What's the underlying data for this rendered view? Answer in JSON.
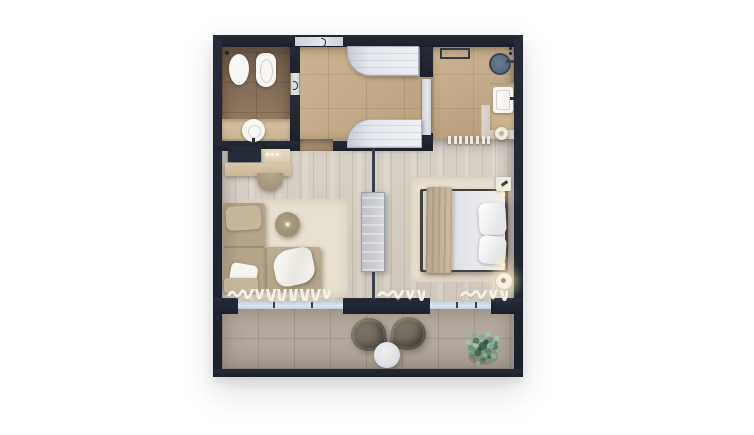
{
  "scene": {
    "type": "floor-plan-3d-render",
    "description": "Top-down 3D render of a one-bedroom hotel suite on a white background",
    "rooms": [
      {
        "id": "wc",
        "label": "guest-wc",
        "fixtures": [
          "toilet",
          "bidet",
          "round-washbasin",
          "vanity-counter",
          "ceiling-spot",
          "door"
        ]
      },
      {
        "id": "entry-closet",
        "label": "entry-hall-closet",
        "fixtures": [
          "entrance-door",
          "wardrobe-top",
          "wardrobe-bottom",
          "sliding-door-to-bathroom"
        ]
      },
      {
        "id": "bathroom",
        "label": "master-bathroom",
        "fixtures": [
          "walk-in-shower-head",
          "shower-controls",
          "wall-shelf",
          "vanity-sink",
          "stool",
          "towel-radiator",
          "wood-floor-corner"
        ]
      },
      {
        "id": "living",
        "label": "living-area",
        "fixtures": [
          "tv-console",
          "desk-shelf",
          "desk-lights",
          "半-round-chair",
          "area-rug",
          "l-shaped-sofa",
          "throw-pillows",
          "white-throw-blanket",
          "round-coffee-table",
          "sheer-curtain"
        ]
      },
      {
        "id": "bedroom",
        "label": "bedroom",
        "fixtures": [
          "area-rug",
          "double-bed",
          "duvet",
          "beige-runner-throw",
          "pillow",
          "pillow",
          "nightstand",
          "bedside-lamp",
          "bedside-lamp-glow",
          "sheer-curtain"
        ]
      },
      {
        "id": "balcony",
        "label": "balcony-terrace",
        "fixtures": [
          "lounge-chair-left",
          "lounge-chair-right",
          "round-side-table",
          "potted-plant"
        ]
      }
    ],
    "architecture": [
      "perimeter-walls",
      "glass-partition",
      "partition-panel",
      "sliding-glass-windows",
      "window-mullions"
    ]
  },
  "palette": {
    "canvasBg": "#ffffff",
    "wall": "#272b37",
    "wallEdge": "#1c202b",
    "door": "#ccd1d8",
    "glass": "#bdcbda",
    "wcFloorA": "#6e5b49",
    "wcFloorB": "#9a8366",
    "counter": "#c7b08b",
    "counterLight": "#d8c5a4",
    "hallA": "#cdb591",
    "hallB": "#b89f7c",
    "bathA": "#cbb491",
    "bathB": "#b29a78",
    "woodA": "#d7d0c6",
    "woodB": "#cfc7bc",
    "balconyA": "#b6aba0",
    "balconyB": "#aea49a",
    "rug": "#e8e0d1",
    "rugBed": "#eae2d3",
    "sofa": "#b2a58a",
    "pillowBeige": "#c3b69a",
    "white": "#f5f4f1",
    "duvetA": "#d5d7dc",
    "duvetB": "#edeef1",
    "throw": "#c2b299",
    "bedFrame": "#46403a",
    "wardrobeA": "#c6ccd7",
    "wardrobeB": "#eef0f3",
    "panel": "#c9cbce",
    "deskWood": "#d8c8ab",
    "shelf": "#e6dac2",
    "chair": "#a3967c",
    "table": "#9d9077",
    "balChair": "#6c6558",
    "balTableA": "#f0f0f1",
    "balTableB": "#c9cdd1",
    "shower": "#5a6a80",
    "showerRim": "#3b4656",
    "glow": "#ffedb9",
    "fixture": "#f7f6f3",
    "plant1": "#4d7d66",
    "plant2": "#67997f",
    "plant3": "#83af94",
    "plant4": "#3c6b55",
    "plant5": "#9ec4aa"
  }
}
